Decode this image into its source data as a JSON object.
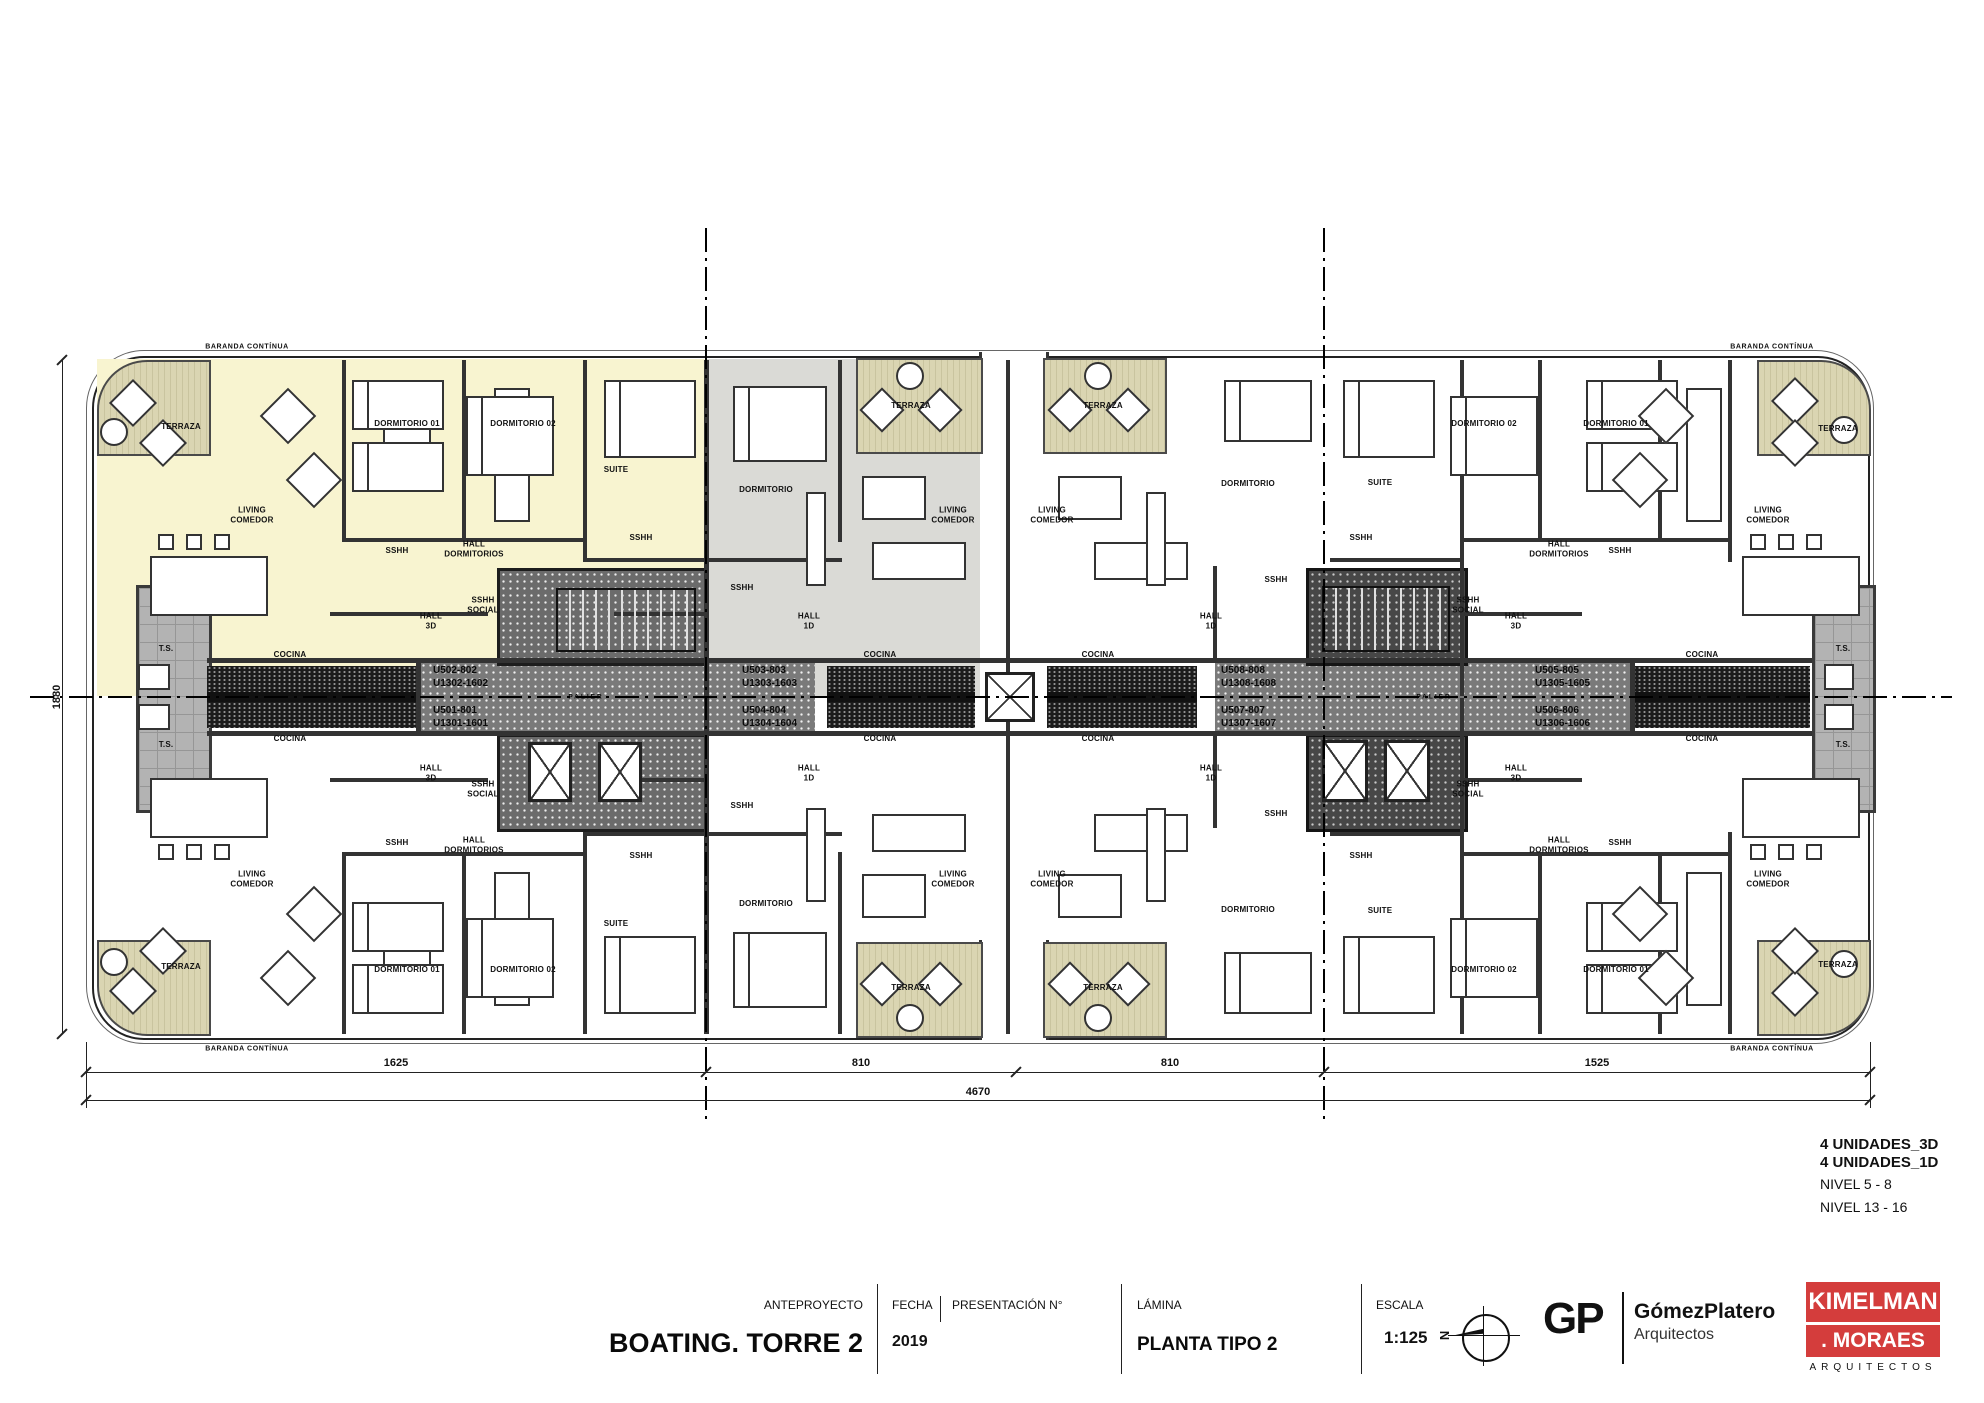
{
  "title_block": {
    "anteproyecto_label": "ANTEPROYECTO",
    "project_title": "BOATING. TORRE 2",
    "fecha_label": "FECHA",
    "presentacion_label": "PRESENTACIÓN N°",
    "fecha_value": "2019",
    "lamina_label": "LÁMINA",
    "lamina_value": "PLANTA TIPO 2",
    "escala_label": "ESCALA",
    "escala_value": "1:125",
    "north_letter": "N",
    "gp_logo": "GP",
    "gp_name": "GómezPlatero",
    "gp_sub": "Arquitectos",
    "km_line1": "KIMELMAN",
    "km_line2": ". MORAES",
    "km_sub": "ARQUITECTOS"
  },
  "annotations": {
    "unidades_3d": "4 UNIDADES_3D",
    "unidades_1d": "4 UNIDADES_1D",
    "nivel_a": "NIVEL 5 - 8",
    "nivel_b": "NIVEL 13 - 16"
  },
  "dimensions": {
    "segments": [
      "1625",
      "810",
      "810",
      "1525"
    ],
    "total": "4670",
    "vertical": "1880"
  },
  "plan": {
    "baranda_label": "BARANDA CONTÍNUA",
    "palier_label": "PALIER",
    "baranda_positions": [
      {
        "x": 247,
        "y": 347
      },
      {
        "x": 1772,
        "y": 347
      },
      {
        "x": 247,
        "y": 1049
      },
      {
        "x": 1772,
        "y": 1049
      }
    ],
    "palier_positions": [
      {
        "x": 586,
        "y": 697
      },
      {
        "x": 1434,
        "y": 697
      }
    ],
    "unit_labels": [
      {
        "l1": "U502-802",
        "l2": "U1302-1602",
        "x": 433,
        "y": 665
      },
      {
        "l1": "U501-801",
        "l2": "U1301-1601",
        "x": 433,
        "y": 705
      },
      {
        "l1": "U503-803",
        "l2": "U1303-1603",
        "x": 742,
        "y": 665
      },
      {
        "l1": "U504-804",
        "l2": "U1304-1604",
        "x": 742,
        "y": 705
      },
      {
        "l1": "U508-808",
        "l2": "U1308-1608",
        "x": 1221,
        "y": 665
      },
      {
        "l1": "U507-807",
        "l2": "U1307-1607",
        "x": 1221,
        "y": 705
      },
      {
        "l1": "U505-805",
        "l2": "U1305-1605",
        "x": 1535,
        "y": 665
      },
      {
        "l1": "U506-806",
        "l2": "U1306-1606",
        "x": 1535,
        "y": 705
      }
    ],
    "room_labels": [
      {
        "t": "TERRAZA",
        "x": 181,
        "y": 427
      },
      {
        "t": "DORMITORIO 01",
        "x": 407,
        "y": 424
      },
      {
        "t": "DORMITORIO 02",
        "x": 523,
        "y": 424
      },
      {
        "t": "SUITE",
        "x": 616,
        "y": 470
      },
      {
        "t": "LIVING\nCOMEDOR",
        "x": 252,
        "y": 515
      },
      {
        "t": "SSHH",
        "x": 397,
        "y": 551
      },
      {
        "t": "HALL\nDORMITORIOS",
        "x": 474,
        "y": 549
      },
      {
        "t": "SSHH",
        "x": 641,
        "y": 538
      },
      {
        "t": "SSHH\nSOCIAL",
        "x": 483,
        "y": 605
      },
      {
        "t": "HALL\n3D",
        "x": 431,
        "y": 621
      },
      {
        "t": "T.S.",
        "x": 166,
        "y": 649
      },
      {
        "t": "COCINA",
        "x": 290,
        "y": 655
      },
      {
        "t": "DORMITORIO",
        "x": 766,
        "y": 490
      },
      {
        "t": "TERRAZA",
        "x": 911,
        "y": 406
      },
      {
        "t": "LIVING\nCOMEDOR",
        "x": 953,
        "y": 515
      },
      {
        "t": "SSHH",
        "x": 742,
        "y": 588
      },
      {
        "t": "HALL\n1D",
        "x": 809,
        "y": 621
      },
      {
        "t": "COCINA",
        "x": 880,
        "y": 655
      },
      {
        "t": "TERRAZA",
        "x": 1103,
        "y": 406
      },
      {
        "t": "LIVING\nCOMEDOR",
        "x": 1052,
        "y": 515
      },
      {
        "t": "DORMITORIO",
        "x": 1248,
        "y": 484
      },
      {
        "t": "SSHH",
        "x": 1276,
        "y": 580
      },
      {
        "t": "HALL\n1D",
        "x": 1211,
        "y": 621
      },
      {
        "t": "COCINA",
        "x": 1098,
        "y": 655
      },
      {
        "t": "SUITE",
        "x": 1380,
        "y": 483
      },
      {
        "t": "SSHH",
        "x": 1361,
        "y": 538
      },
      {
        "t": "SSHH\nSOCIAL",
        "x": 1468,
        "y": 605
      },
      {
        "t": "HALL\n3D",
        "x": 1516,
        "y": 621
      },
      {
        "t": "DORMITORIO 02",
        "x": 1484,
        "y": 424
      },
      {
        "t": "DORMITORIO 01",
        "x": 1616,
        "y": 424
      },
      {
        "t": "HALL\nDORMITORIOS",
        "x": 1559,
        "y": 549
      },
      {
        "t": "SSHH",
        "x": 1620,
        "y": 551
      },
      {
        "t": "LIVING\nCOMEDOR",
        "x": 1768,
        "y": 515
      },
      {
        "t": "TERRAZA",
        "x": 1838,
        "y": 429
      },
      {
        "t": "COCINA",
        "x": 1702,
        "y": 655
      },
      {
        "t": "T.S.",
        "x": 1843,
        "y": 649
      },
      {
        "t": "TERRAZA",
        "x": 181,
        "y": 967
      },
      {
        "t": "DORMITORIO 01",
        "x": 407,
        "y": 970
      },
      {
        "t": "DORMITORIO 02",
        "x": 523,
        "y": 970
      },
      {
        "t": "SUITE",
        "x": 616,
        "y": 924
      },
      {
        "t": "LIVING\nCOMEDOR",
        "x": 252,
        "y": 879
      },
      {
        "t": "SSHH",
        "x": 397,
        "y": 843
      },
      {
        "t": "HALL\nDORMITORIOS",
        "x": 474,
        "y": 845
      },
      {
        "t": "SSHH",
        "x": 641,
        "y": 856
      },
      {
        "t": "SSHH\nSOCIAL",
        "x": 483,
        "y": 789
      },
      {
        "t": "HALL\n3D",
        "x": 431,
        "y": 773
      },
      {
        "t": "T.S.",
        "x": 166,
        "y": 745
      },
      {
        "t": "COCINA",
        "x": 290,
        "y": 739
      },
      {
        "t": "DORMITORIO",
        "x": 766,
        "y": 904
      },
      {
        "t": "TERRAZA",
        "x": 911,
        "y": 988
      },
      {
        "t": "LIVING\nCOMEDOR",
        "x": 953,
        "y": 879
      },
      {
        "t": "SSHH",
        "x": 742,
        "y": 806
      },
      {
        "t": "HALL\n1D",
        "x": 809,
        "y": 773
      },
      {
        "t": "COCINA",
        "x": 880,
        "y": 739
      },
      {
        "t": "TERRAZA",
        "x": 1103,
        "y": 988
      },
      {
        "t": "LIVING\nCOMEDOR",
        "x": 1052,
        "y": 879
      },
      {
        "t": "DORMITORIO",
        "x": 1248,
        "y": 910
      },
      {
        "t": "SSHH",
        "x": 1276,
        "y": 814
      },
      {
        "t": "HALL\n1D",
        "x": 1211,
        "y": 773
      },
      {
        "t": "COCINA",
        "x": 1098,
        "y": 739
      },
      {
        "t": "SUITE",
        "x": 1380,
        "y": 911
      },
      {
        "t": "SSHH",
        "x": 1361,
        "y": 856
      },
      {
        "t": "SSHH\nSOCIAL",
        "x": 1468,
        "y": 789
      },
      {
        "t": "HALL\n3D",
        "x": 1516,
        "y": 773
      },
      {
        "t": "DORMITORIO 02",
        "x": 1484,
        "y": 970
      },
      {
        "t": "DORMITORIO 01",
        "x": 1616,
        "y": 970
      },
      {
        "t": "HALL\nDORMITORIOS",
        "x": 1559,
        "y": 845
      },
      {
        "t": "SSHH",
        "x": 1620,
        "y": 843
      },
      {
        "t": "LIVING\nCOMEDOR",
        "x": 1768,
        "y": 879
      },
      {
        "t": "TERRAZA",
        "x": 1838,
        "y": 965
      },
      {
        "t": "COCINA",
        "x": 1702,
        "y": 739
      },
      {
        "t": "T.S.",
        "x": 1843,
        "y": 745
      }
    ]
  },
  "colors": {
    "unit_3d_highlight": "#f8f4d0",
    "unit_1d_highlight": "#dadad6",
    "terraza": "#dad5b2",
    "corridor": "#7a7a7a",
    "core_dark": "#474747",
    "brand_red": "#d43d3c"
  }
}
